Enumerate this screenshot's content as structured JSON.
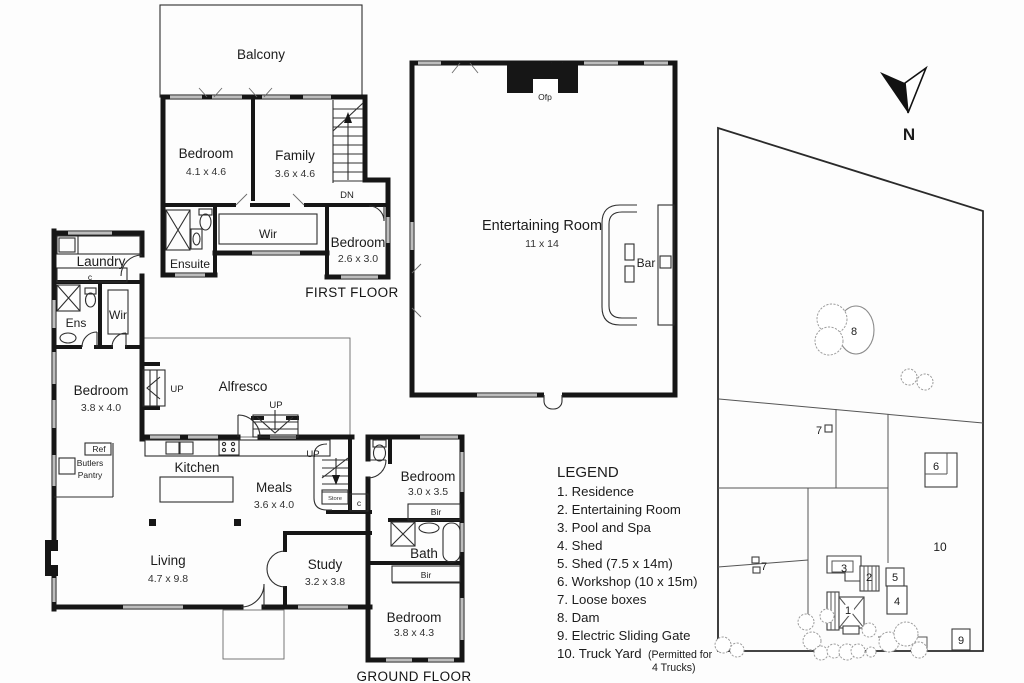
{
  "first_floor": {
    "title": "FIRST FLOOR",
    "balcony": "Balcony",
    "bedroom1_name": "Bedroom",
    "bedroom1_dims": "4.1 x 4.6",
    "family_name": "Family",
    "family_dims": "3.6 x 4.6",
    "dn": "DN",
    "ensuite": "Ensuite",
    "wir": "Wir",
    "bedroom2_name": "Bedroom",
    "bedroom2_dims": "2.6 x 3.0"
  },
  "entertaining_room": {
    "name": "Entertaining Room",
    "dims": "11 x 14",
    "ofp": "Ofp",
    "bar": "Bar"
  },
  "ground_floor": {
    "title": "GROUND FLOOR",
    "laundry": "Laundry",
    "laundry_cupboard": "c",
    "ens": "Ens",
    "wir": "Wir",
    "bedroom1_name": "Bedroom",
    "bedroom1_dims": "3.8 x 4.0",
    "alfresco": "Alfresco",
    "up_left": "UP",
    "up_center": "UP",
    "up_stairs": "UP",
    "ref": "Ref",
    "butlers_line1": "Butlers",
    "butlers_line2": "Pantry",
    "kitchen": "Kitchen",
    "meals_name": "Meals",
    "meals_dims": "3.6 x 4.0",
    "store": "Store",
    "closet": "c",
    "bedroom2_name": "Bedroom",
    "bedroom2_dims": "3.0 x 3.5",
    "bir1": "Bir",
    "bath": "Bath",
    "bir2": "Bir",
    "living_name": "Living",
    "living_dims": "4.7 x 9.8",
    "study_name": "Study",
    "study_dims": "3.2 x 3.8",
    "bedroom3_name": "Bedroom",
    "bedroom3_dims": "3.8 x 4.3"
  },
  "site_plan": {
    "north": "N",
    "marker_1": "1",
    "marker_2": "2",
    "marker_3": "3",
    "marker_4": "4",
    "marker_5": "5",
    "marker_6": "6",
    "marker_7_top": "7",
    "marker_7_left": "7",
    "marker_8": "8",
    "marker_9": "9",
    "marker_10": "10"
  },
  "legend": {
    "title": "LEGEND",
    "items": [
      "1. Residence",
      "2. Entertaining Room",
      "3. Pool and Spa",
      "4. Shed",
      "5. Shed (7.5 x 14m)",
      "6. Workshop (10 x 15m)",
      "7. Loose boxes",
      "8. Dam",
      "9. Electric Sliding Gate"
    ],
    "item10_main": "10. Truck Yard",
    "item10_note_line1": "(Permitted for",
    "item10_note_line2": "4 Trucks)"
  },
  "colors": {
    "wall": "#161616",
    "window": "#bdbdbd",
    "background": "#fdfdfd"
  }
}
